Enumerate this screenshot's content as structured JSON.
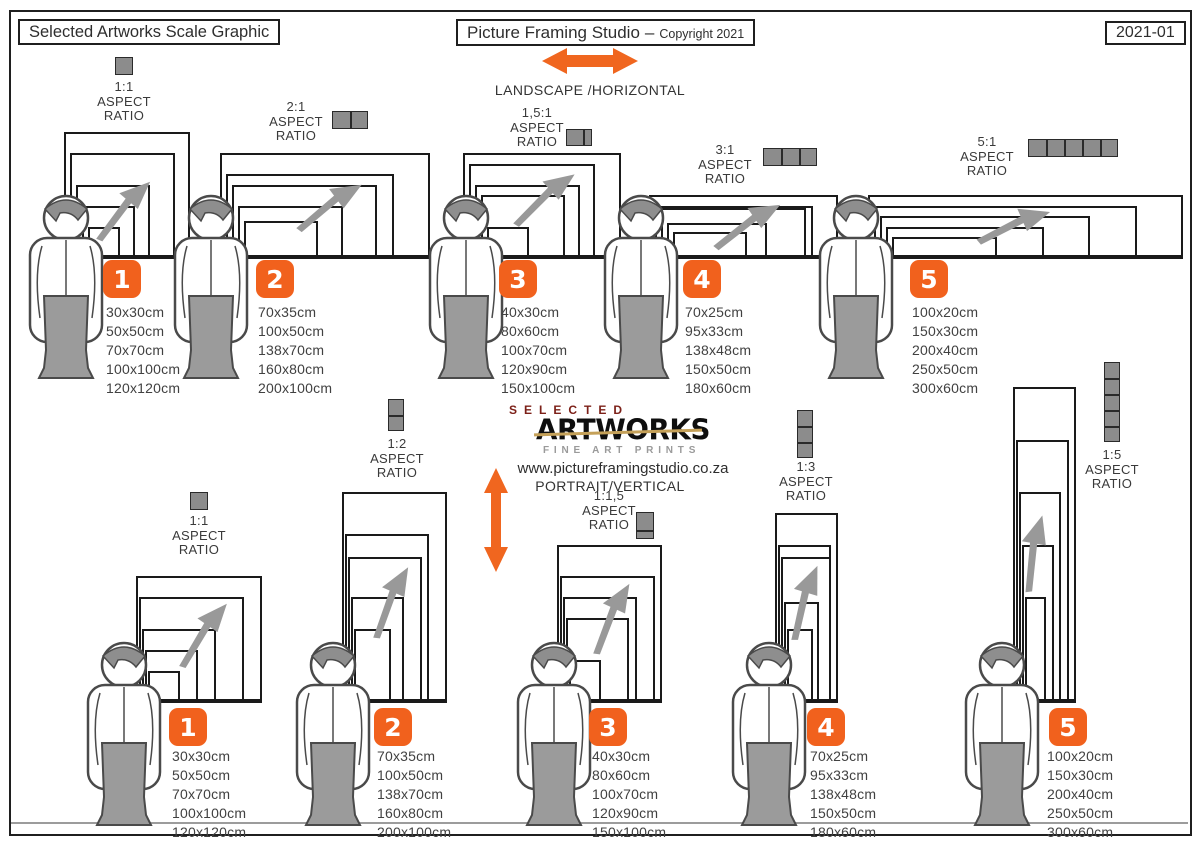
{
  "header": {
    "left_title": "Selected Artworks Scale Graphic",
    "studio_title": "Picture Framing Studio",
    "separator": "–",
    "copyright": "Copyright 2021",
    "edition": "2021-01"
  },
  "landscape_section": {
    "heading": "LANDSCAPE /HORIZONTAL",
    "arrow_icon": "orange-horizontal-double-arrow"
  },
  "portrait_section": {
    "heading": "PORTRAIT/VERTICAL",
    "arrow_icon": "orange-vertical-double-arrow"
  },
  "logo": {
    "top": "SELECTED",
    "main": "ARTWORKS",
    "sub": "FINE ART PRINTS",
    "website": "www.pictureframingstudio.co.za"
  },
  "aspect_words": [
    "ASPECT",
    "RATIO"
  ],
  "colors": {
    "accent_orange": "#F1611D",
    "icon_gray": "#8C8C8C",
    "figure_gray": "#9B9B9B",
    "line_black": "#1a1a1a",
    "logo_red": "#7c2018",
    "logo_gold": "#c5a159"
  },
  "groups": {
    "landscape": [
      {
        "number": "1",
        "ratio": "1:1",
        "icon": "squares-1-horizontal",
        "sizes": [
          "30x30cm",
          "50x50cm",
          "70x70cm",
          "100x100cm",
          "120x120cm"
        ]
      },
      {
        "number": "2",
        "ratio": "2:1",
        "icon": "squares-2-horizontal",
        "sizes": [
          "70x35cm",
          "100x50cm",
          "138x70cm",
          "160x80cm",
          "200x100cm"
        ]
      },
      {
        "number": "3",
        "ratio": "1,5:1",
        "icon": "squares-1.5-horizontal",
        "sizes": [
          "40x30cm",
          "80x60cm",
          "100x70cm",
          "120x90cm",
          "150x100cm"
        ]
      },
      {
        "number": "4",
        "ratio": "3:1",
        "icon": "squares-3-horizontal",
        "sizes": [
          "70x25cm",
          "95x33cm",
          "138x48cm",
          "150x50cm",
          "180x60cm"
        ]
      },
      {
        "number": "5",
        "ratio": "5:1",
        "icon": "squares-5-horizontal",
        "sizes": [
          "100x20cm",
          "150x30cm",
          "200x40cm",
          "250x50cm",
          "300x60cm"
        ]
      }
    ],
    "portrait": [
      {
        "number": "1",
        "ratio": "1:1",
        "icon": "squares-1-vertical",
        "sizes": [
          "30x30cm",
          "50x50cm",
          "70x70cm",
          "100x100cm",
          "120x120cm"
        ]
      },
      {
        "number": "2",
        "ratio": "1:2",
        "icon": "squares-2-vertical",
        "sizes": [
          "70x35cm",
          "100x50cm",
          "138x70cm",
          "160x80cm",
          "200x100cm"
        ]
      },
      {
        "number": "3",
        "ratio": "1:1,5",
        "icon": "squares-1.5-vertical",
        "sizes": [
          "40x30cm",
          "80x60cm",
          "100x70cm",
          "120x90cm",
          "150x100cm"
        ]
      },
      {
        "number": "4",
        "ratio": "1:3",
        "icon": "squares-3-vertical",
        "sizes": [
          "70x25cm",
          "95x33cm",
          "138x48cm",
          "150x50cm",
          "180x60cm"
        ]
      },
      {
        "number": "5",
        "ratio": "1:5",
        "icon": "squares-5-vertical",
        "sizes": [
          "100x20cm",
          "150x30cm",
          "200x40cm",
          "250x50cm",
          "300x60cm"
        ]
      }
    ]
  }
}
